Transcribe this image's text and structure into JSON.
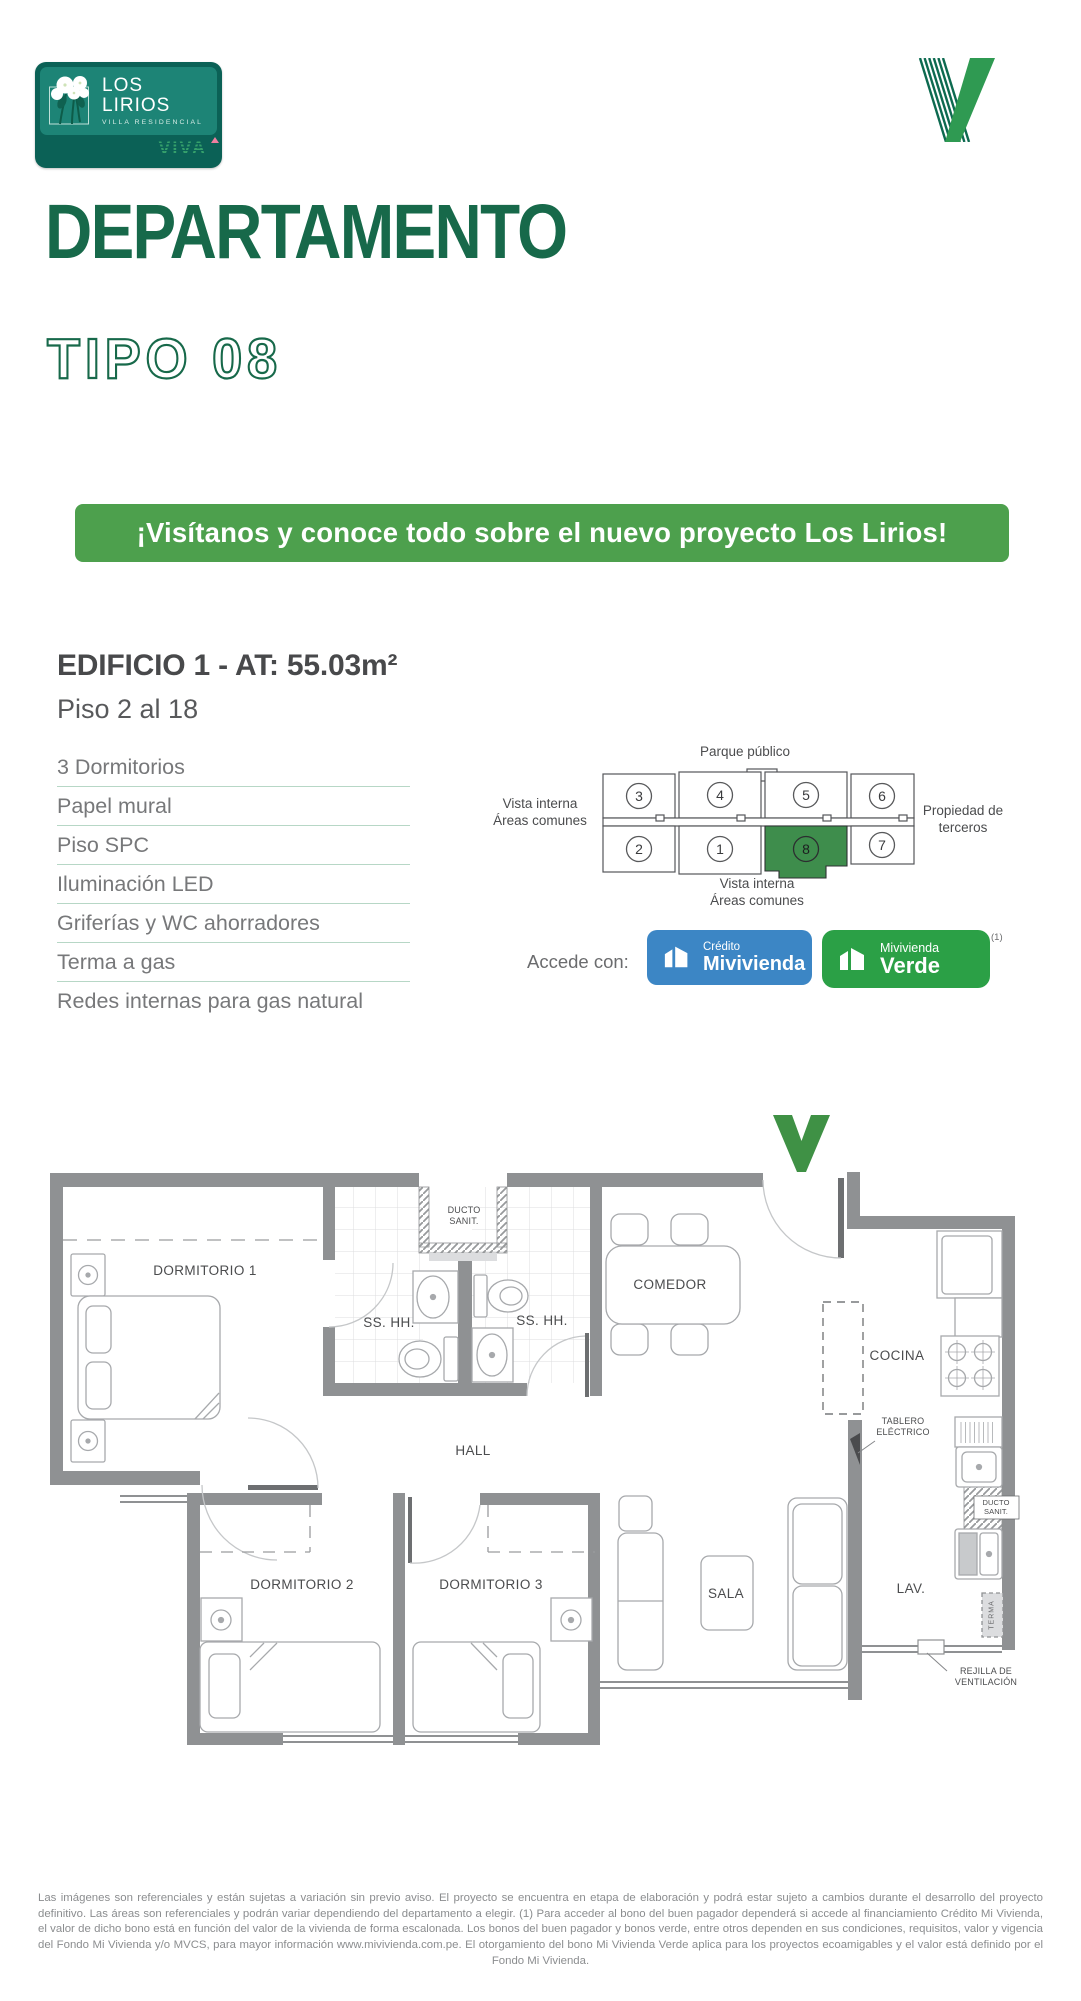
{
  "logo_card": {
    "title": "LOS LIRIOS",
    "subtitle": "VILLA RESIDENCIAL",
    "brand": "VIVA"
  },
  "title": {
    "main": "DEPARTAMENTO",
    "sub": "TIPO 08"
  },
  "banner": "¡Visítanos y conoce todo sobre el nuevo proyecto Los Lirios!",
  "building": {
    "heading": "EDIFICIO 1 - AT: 55.03m²",
    "floors": "Piso 2 al 18"
  },
  "features": [
    "3 Dormitorios",
    "Papel mural",
    "Piso SPC",
    "Iluminación LED",
    "Griferías y WC ahorradores",
    "Terma a gas",
    "Redes internas para gas natural"
  ],
  "keyplan": {
    "top_label": "Parque público",
    "left_label": [
      "Vista interna",
      "Áreas comunes"
    ],
    "bottom_label": [
      "Vista interna",
      "Áreas comunes"
    ],
    "right_label": [
      "Propiedad de",
      "terceros"
    ],
    "units_top": [
      "3",
      "4",
      "5",
      "6"
    ],
    "units_bottom": [
      "2",
      "1",
      "8",
      "7"
    ],
    "highlighted_unit": "8"
  },
  "access": {
    "label": "Accede con:",
    "badge1_line1": "Crédito",
    "badge1_line2": "Mivivienda",
    "badge2_line1": "Mivivienda",
    "badge2_line2": "Verde",
    "footnote": "(1)"
  },
  "floorplan": {
    "dormitorio1": "DORMITORIO 1",
    "sshh1": "SS. HH.",
    "sshh2": "SS. HH.",
    "ducto_line1": "DUCTO",
    "ducto_line2": "SANIT.",
    "comedor": "COMEDOR",
    "cocina": "COCINA",
    "hall": "HALL",
    "dormitorio2": "DORMITORIO 2",
    "dormitorio3": "DORMITORIO 3",
    "sala": "SALA",
    "lav": "LAV.",
    "tablero_line1": "TABLERO",
    "tablero_line2": "ELÉCTRICO",
    "ducto2_line1": "DUCTO",
    "ducto2_line2": "SANIT.",
    "terma": "TERMA",
    "rejilla_line1": "REJILLA DE",
    "rejilla_line2": "VENTILACIÓN"
  },
  "disclaimer": "Las imágenes son referenciales y están sujetas a variación sin previo aviso. El proyecto se encuentra en etapa de elaboración y podrá estar sujeto a cambios durante el desarrollo del proyecto definitivo. Las áreas son referenciales y podrán variar dependiendo del departamento a elegir. (1) Para acceder al bono del buen pagador dependerá si accede al financiamiento Crédito Mi Vivienda, el valor de dicho bono está en función del valor de la vivienda de forma escalonada. Los bonos del buen pagador y bonos verde, entre otros dependen en sus condiciones, requisitos, valor y vigencia del Fondo Mi Vivienda y/o MVCS, para mayor información www.mivivienda.com.pe. El otorgamiento del bono Mi Vivienda Verde aplica para los proyectos ecoamigables y el valor está definido por el Fondo Mi Vivienda.",
  "colors": {
    "brand_green": "#17694a",
    "banner_green": "#4da04d",
    "badge_blue": "#3c86c5",
    "badge_green": "#2ba046",
    "keyplan_green": "#3e8d4c",
    "teal_dark": "#0b6156",
    "teal": "#1d8476",
    "wall_gray": "#8f9193"
  }
}
